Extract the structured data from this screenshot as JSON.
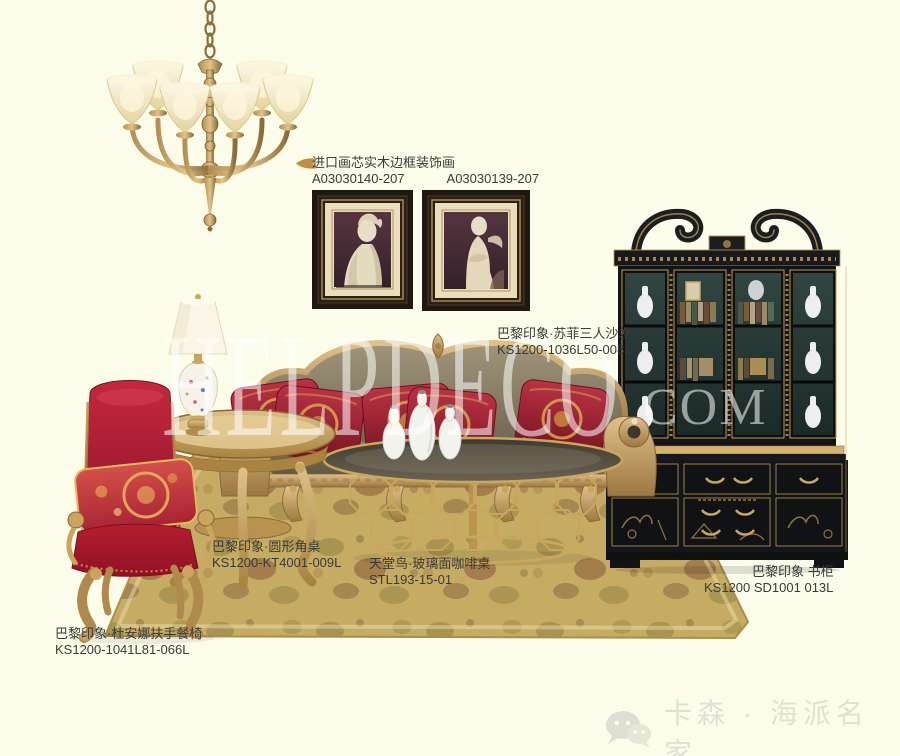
{
  "colors": {
    "background": "#fbfce9",
    "gold_accent": "#c9a55e",
    "rug_base": "#c6ac63",
    "chair_red": "#b51e30",
    "pillow_red": "#a32331",
    "bookcase_black": "#15171a",
    "painting_mat": "#e9dfbe",
    "painting_inner": "#4a323c",
    "label_text": "#3a3a3a",
    "watermark_white": "rgba(255,255,255,0.55)",
    "footer_text": "#e0e0d4"
  },
  "watermark": {
    "text": "HELPDECO",
    "suffix": ".COM"
  },
  "labels": {
    "paintings": {
      "title": "进口画芯实木边框装饰画",
      "code_left": "A03030140-207",
      "code_right": "A03030139-207"
    },
    "sofa": {
      "title": "巴黎印象·苏菲三人沙发",
      "code": "KS1200-1036L50-008L"
    },
    "side_table": {
      "title": "巴黎印象·圆形角桌",
      "code": "KS1200-KT4001-009L"
    },
    "coffee_table": {
      "title": "天堂鸟·玻璃面咖啡桌",
      "code": "STL193-15-01"
    },
    "bookcase": {
      "title": "巴黎印象 书柜",
      "code": "KS1200 SD1001 013L"
    },
    "chair": {
      "title": "巴黎印象·杜安娜扶手餐椅",
      "code": "KS1200-1041L81-066L"
    }
  },
  "footer": {
    "brand": "卡森 · 海派名家",
    "icon": "wechat-icon"
  }
}
